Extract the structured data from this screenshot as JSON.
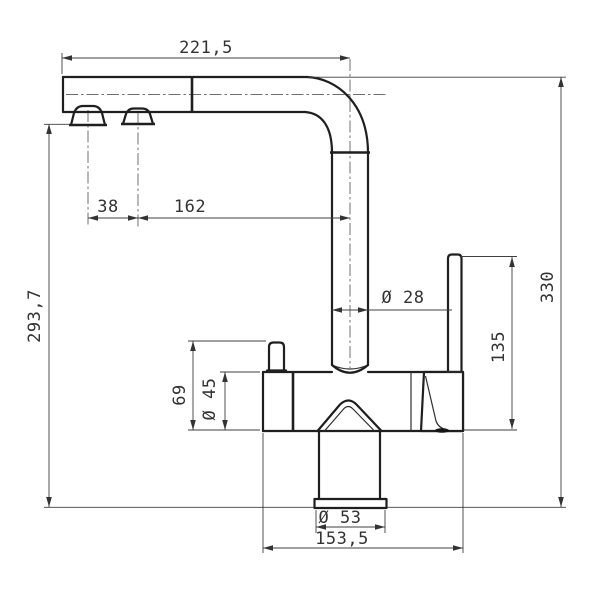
{
  "drawing": {
    "kind": "technical-dimension-drawing",
    "subject": "kitchen mixer tap, side elevation",
    "colors": {
      "background": "#ffffff",
      "object_lines": "#1f1f1f",
      "dimension_lines": "#3f3f3f",
      "text": "#333333"
    },
    "dims": {
      "spout_reach": "221,5",
      "outlet_spacing": "38",
      "outlet_to_riser": "162",
      "outlet_height": "293,7",
      "overall_height": "330",
      "riser_diameter": "Ø 28",
      "lever_height": "135",
      "side_valve_height": "69",
      "body_diameter": "Ø 45",
      "base_diameter": "Ø 53",
      "base_span": "153,5"
    }
  }
}
